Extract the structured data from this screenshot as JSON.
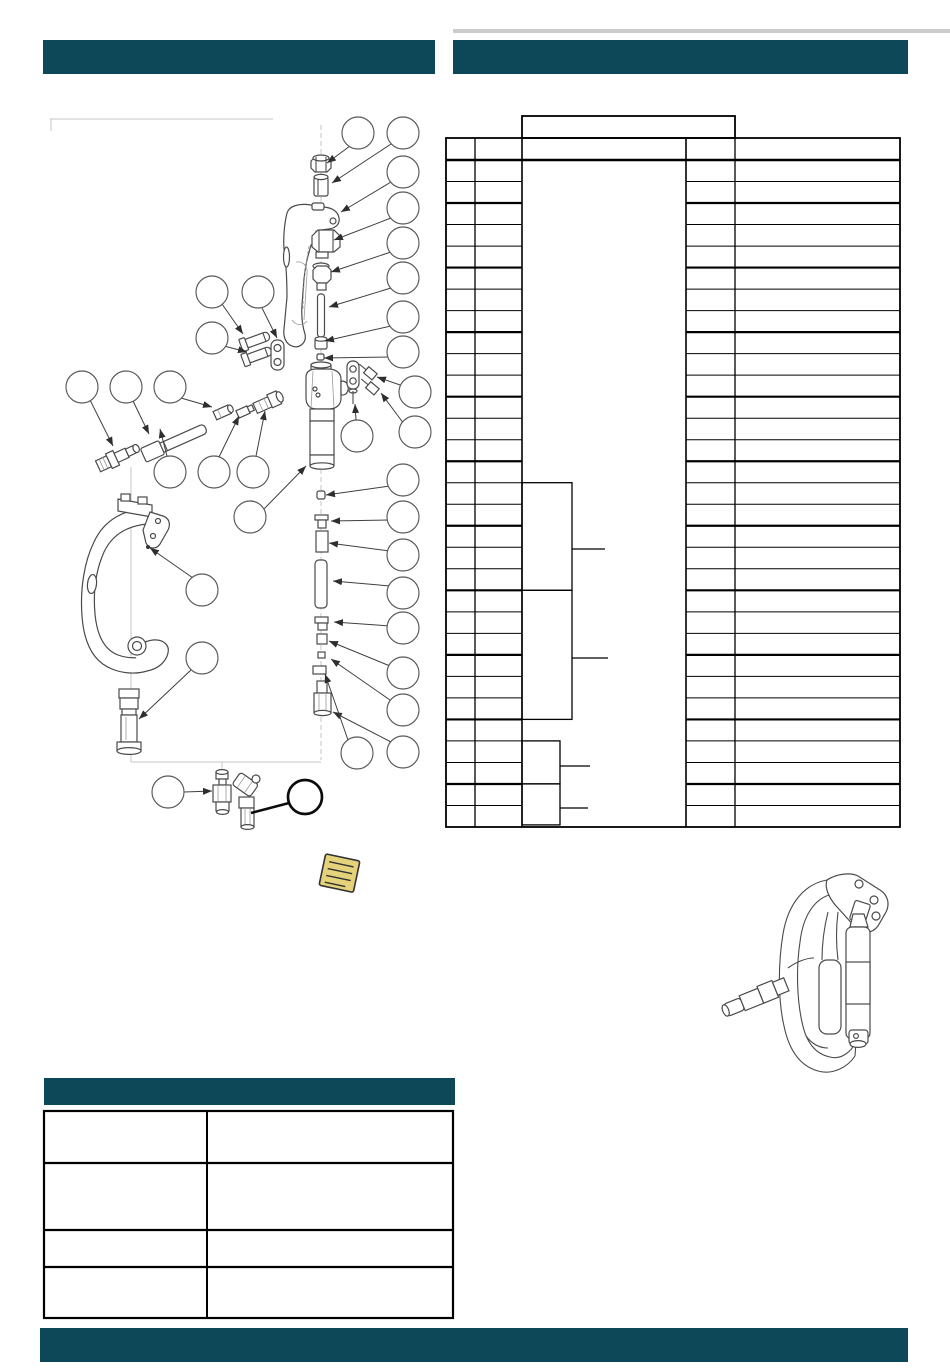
{
  "page": {
    "width": 950,
    "height": 1369,
    "background": "#ffffff",
    "kind": "scanned parts manual page, all text blank/redacted"
  },
  "colors": {
    "accent_teal": "#0d4859",
    "table_border": "#000000",
    "drawing_stroke": "#4a4a4a",
    "construction_line": "#c4c4c4",
    "note_yellow": "#e4d37b",
    "scan_strip": "#cccccc"
  },
  "header": {
    "left_bar_text": "",
    "right_bar_text": ""
  },
  "footer": {
    "bar_text": ""
  },
  "parts_table": {
    "x_cols": [
      446,
      475,
      522,
      686,
      735,
      900
    ],
    "top": 160,
    "outer_top": 138,
    "bottom": 827,
    "row_count": 31,
    "row_pitch": 21.516,
    "thick_rows": [
      2,
      5,
      8,
      11,
      14,
      17,
      20,
      23,
      26,
      29
    ],
    "header_box": {
      "x": 522,
      "y": 116,
      "w": 213,
      "h": 22
    },
    "brackets": [
      {
        "x": 522,
        "y": 482.7,
        "w": 50,
        "h": 107.6,
        "tick_y": 549,
        "tick_len": 33
      },
      {
        "x": 522,
        "y": 590.3,
        "w": 50,
        "h": 129.1,
        "tick_y": 658,
        "tick_len": 36
      },
      {
        "x": 522,
        "y": 740.9,
        "w": 38,
        "h": 43.0,
        "tick_y": 766,
        "tick_len": 30
      },
      {
        "x": 522,
        "y": 783.9,
        "w": 38,
        "h": 41.0,
        "tick_y": 808,
        "tick_len": 28
      }
    ],
    "cell_text": ""
  },
  "info_table": {
    "x": 44,
    "y": 1111,
    "w": 409,
    "h": 207,
    "col_divider_x": 207,
    "row_lines_y": [
      1163,
      1230,
      1267
    ],
    "cell_text": ""
  },
  "diagram": {
    "figure_type": "exploded-parts-diagram",
    "balloons": [
      {
        "cx": 358,
        "cy": 133
      },
      {
        "cx": 403,
        "cy": 133
      },
      {
        "cx": 403,
        "cy": 172
      },
      {
        "cx": 403,
        "cy": 208
      },
      {
        "cx": 403,
        "cy": 243
      },
      {
        "cx": 403,
        "cy": 278
      },
      {
        "cx": 403,
        "cy": 317
      },
      {
        "cx": 403,
        "cy": 352
      },
      {
        "cx": 415,
        "cy": 392
      },
      {
        "cx": 415,
        "cy": 432
      },
      {
        "cx": 357,
        "cy": 436
      },
      {
        "cx": 403,
        "cy": 480
      },
      {
        "cx": 403,
        "cy": 517
      },
      {
        "cx": 403,
        "cy": 555
      },
      {
        "cx": 403,
        "cy": 593
      },
      {
        "cx": 403,
        "cy": 628
      },
      {
        "cx": 403,
        "cy": 673
      },
      {
        "cx": 403,
        "cy": 710
      },
      {
        "cx": 403,
        "cy": 752
      },
      {
        "cx": 357,
        "cy": 753
      },
      {
        "cx": 212,
        "cy": 292
      },
      {
        "cx": 258,
        "cy": 292
      },
      {
        "cx": 212,
        "cy": 338
      },
      {
        "cx": 82,
        "cy": 387
      },
      {
        "cx": 126,
        "cy": 387
      },
      {
        "cx": 170,
        "cy": 387
      },
      {
        "cx": 170,
        "cy": 472
      },
      {
        "cx": 214,
        "cy": 472
      },
      {
        "cx": 253,
        "cy": 472
      },
      {
        "cx": 250,
        "cy": 517
      },
      {
        "cx": 202,
        "cy": 590
      },
      {
        "cx": 202,
        "cy": 658
      },
      {
        "cx": 168,
        "cy": 792
      },
      {
        "cx": 305,
        "cy": 797,
        "r": 17,
        "bold": true
      }
    ],
    "leaders": [
      {
        "x1": 350,
        "y1": 146,
        "x2": 327,
        "y2": 163
      },
      {
        "x1": 391,
        "y1": 144,
        "x2": 332,
        "y2": 183
      },
      {
        "x1": 391,
        "y1": 182,
        "x2": 341,
        "y2": 212
      },
      {
        "x1": 391,
        "y1": 218,
        "x2": 334,
        "y2": 240
      },
      {
        "x1": 391,
        "y1": 252,
        "x2": 331,
        "y2": 272
      },
      {
        "x1": 391,
        "y1": 288,
        "x2": 329,
        "y2": 307
      },
      {
        "x1": 391,
        "y1": 326,
        "x2": 325,
        "y2": 341
      },
      {
        "x1": 390,
        "y1": 357,
        "x2": 324,
        "y2": 358
      },
      {
        "x1": 403,
        "y1": 386,
        "x2": 377,
        "y2": 377
      },
      {
        "x1": 404,
        "y1": 424,
        "x2": 381,
        "y2": 393
      },
      {
        "x1": 356,
        "y1": 420,
        "x2": 355,
        "y2": 404
      },
      {
        "x1": 390,
        "y1": 486,
        "x2": 326,
        "y2": 495
      },
      {
        "x1": 390,
        "y1": 520,
        "x2": 331,
        "y2": 521
      },
      {
        "x1": 390,
        "y1": 551,
        "x2": 329,
        "y2": 543
      },
      {
        "x1": 390,
        "y1": 586,
        "x2": 333,
        "y2": 581
      },
      {
        "x1": 390,
        "y1": 626,
        "x2": 334,
        "y2": 622
      },
      {
        "x1": 390,
        "y1": 666,
        "x2": 329,
        "y2": 641
      },
      {
        "x1": 390,
        "y1": 700,
        "x2": 331,
        "y2": 659
      },
      {
        "x1": 391,
        "y1": 742,
        "x2": 333,
        "y2": 712
      },
      {
        "x1": 348,
        "y1": 740,
        "x2": 325,
        "y2": 674
      },
      {
        "x1": 222,
        "y1": 304,
        "x2": 243,
        "y2": 334
      },
      {
        "x1": 262,
        "y1": 308,
        "x2": 277,
        "y2": 338
      },
      {
        "x1": 224,
        "y1": 346,
        "x2": 247,
        "y2": 352
      },
      {
        "x1": 90,
        "y1": 400,
        "x2": 113,
        "y2": 446
      },
      {
        "x1": 133,
        "y1": 401,
        "x2": 149,
        "y2": 434
      },
      {
        "x1": 181,
        "y1": 398,
        "x2": 212,
        "y2": 407
      },
      {
        "x1": 167,
        "y1": 456,
        "x2": 160,
        "y2": 429
      },
      {
        "x1": 219,
        "y1": 457,
        "x2": 239,
        "y2": 416
      },
      {
        "x1": 256,
        "y1": 456,
        "x2": 265,
        "y2": 411
      },
      {
        "x1": 263,
        "y1": 510,
        "x2": 306,
        "y2": 466
      },
      {
        "x1": 193,
        "y1": 578,
        "x2": 150,
        "y2": 548
      },
      {
        "x1": 191,
        "y1": 670,
        "x2": 139,
        "y2": 719
      },
      {
        "x1": 184,
        "y1": 792,
        "x2": 212,
        "y2": 791
      },
      {
        "x1": 289,
        "y1": 803,
        "x2": 251,
        "y2": 813,
        "bold": true
      }
    ]
  },
  "note_icon": {
    "name": "note-icon",
    "lines": 4
  }
}
